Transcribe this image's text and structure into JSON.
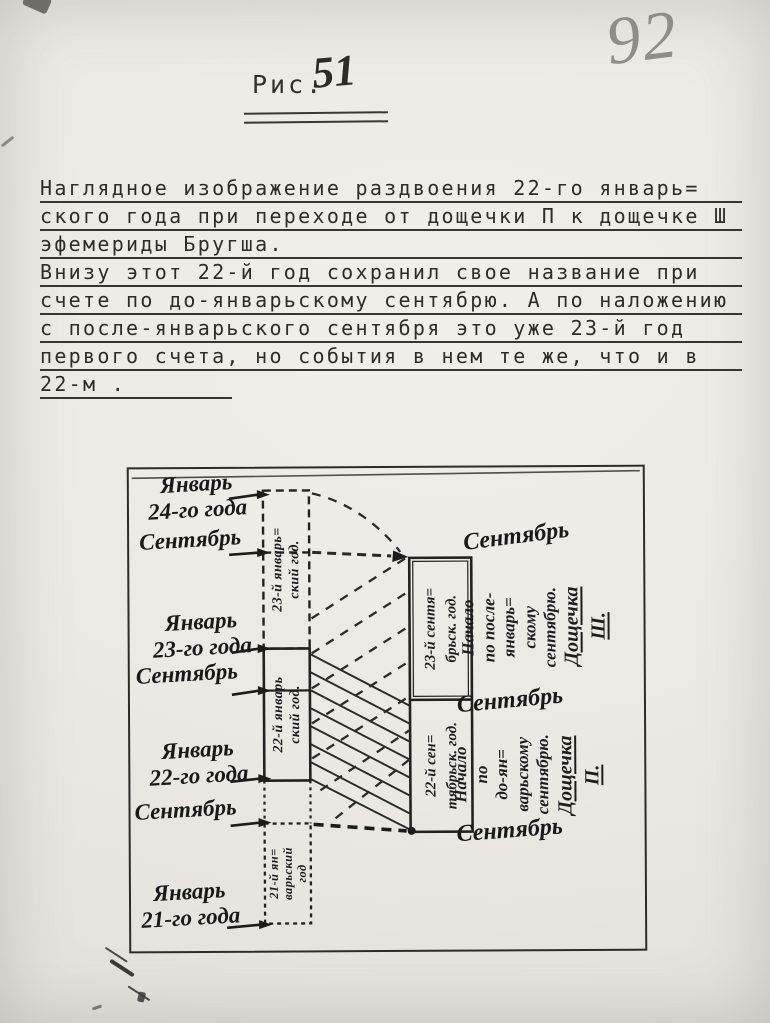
{
  "page": {
    "number": "92"
  },
  "figure": {
    "label": "Рис.",
    "number": "51"
  },
  "paragraph": {
    "lines": [
      "Наглядное изображение раздвоения 22-го январь=",
      "ского года при переходе от дощечки П к дощечке Ш",
      "эфемериды Бругша.",
      "Внизу этот 22-й год сохранил свое название при",
      "счете по до-январьскому сентябрю. А по наложению",
      "с после-январьского сентября это уже 23-й  год",
      "первого счета, но события в нем те же, что и  в",
      "22-м ."
    ]
  },
  "diagram": {
    "left_labels": [
      "Январь\n24-го года",
      "Сентябрь",
      "Январь\n23-го года",
      "Сентябрь",
      "Январь\n22-го года",
      "Сентябрь",
      "Январь\n21-го года"
    ],
    "left_strip": {
      "year23": "23-й январь=\nский год.",
      "year22": "22-й январь\nский год.",
      "year21": "21-й ян=\nварьский\nгод"
    },
    "right_strip": {
      "year23": "23-й сентя=\nбрьск. год.",
      "year22": "22-й сен=\nтябрьск. год."
    },
    "right_labels": {
      "september_top": "Сентябрь",
      "note_top": "Начало\nпо после-\nянварь=\nскому\nсентябрю.",
      "plate_top": "Дощечка\nШ.",
      "september_mid": "Сентябрь",
      "note_bottom": "Начало\nпо\nдо-ян=\nварьскому\nсентябрю.",
      "plate_bottom": "Дощечка\nП.",
      "september_bottom": "Сентябрь"
    }
  },
  "colors": {
    "paper": "#ebe9e3",
    "ink": "#1d1d1d",
    "pencil": "#8f8d88"
  }
}
